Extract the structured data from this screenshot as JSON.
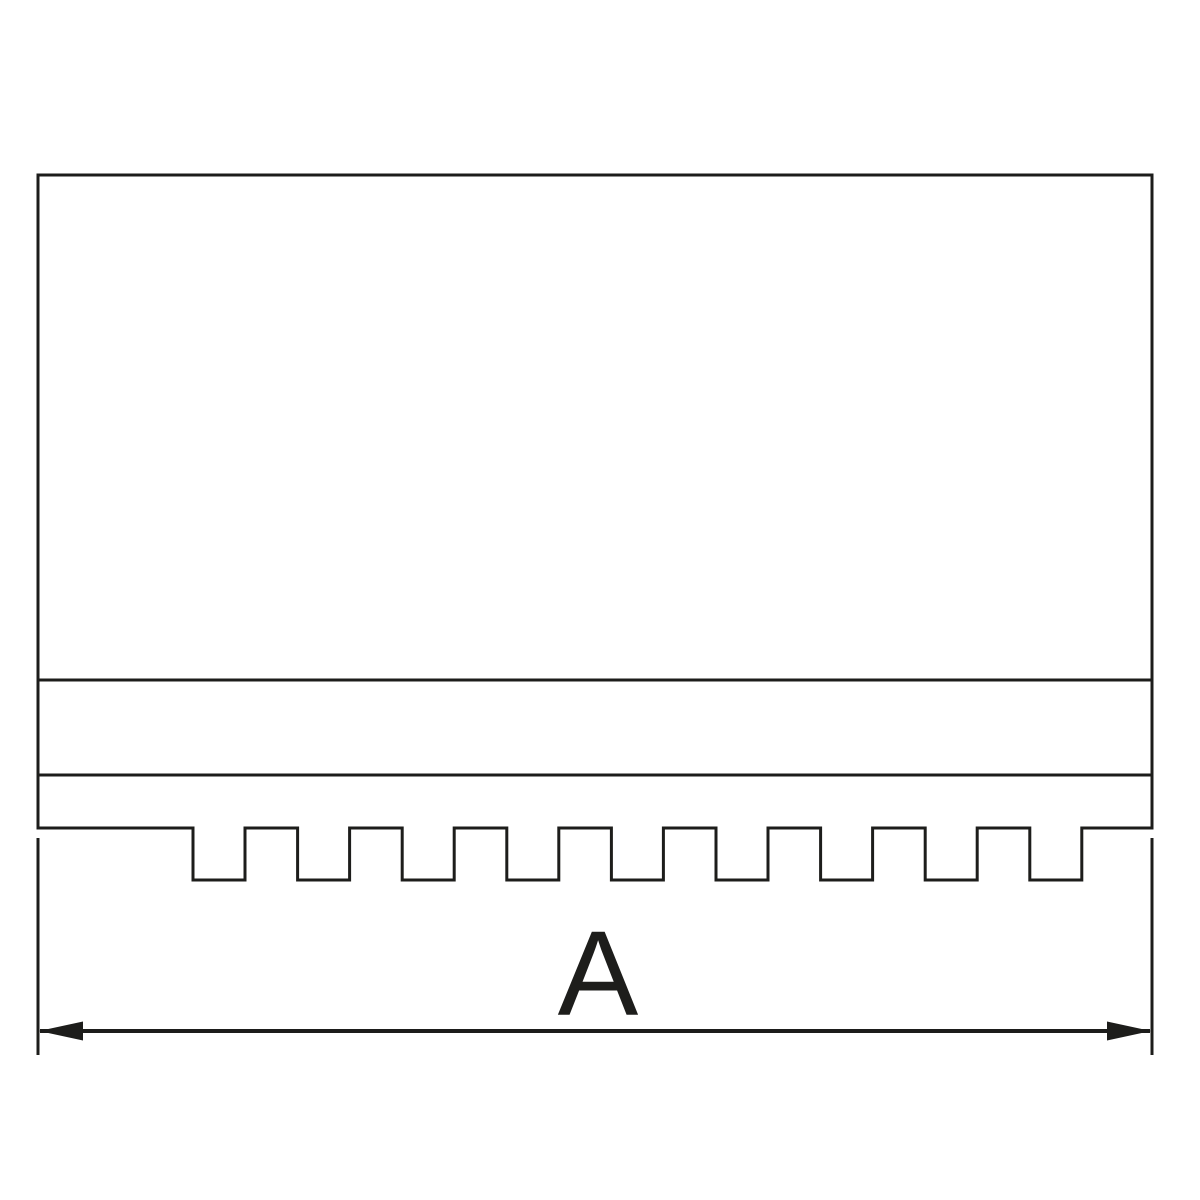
{
  "drawing": {
    "kind": "technical-profile-drawing",
    "dimension_label": "A",
    "line_color": "#1d1d1b",
    "background_color": "#ffffff",
    "geometry": {
      "canvas": {
        "width": 1200,
        "height": 1200
      },
      "body": {
        "left": 38,
        "right": 1152,
        "top": 175,
        "bottom": 828
      },
      "section_lines_y": [
        680,
        775
      ],
      "serration": {
        "notch_count": 9,
        "first_notch_x": 193,
        "pitch": 104.6,
        "notch_width": 52,
        "tooth_depth": 52
      },
      "dimension": {
        "line_y": 1031,
        "ext_top": 838,
        "ext_bottom": 1055,
        "arrow_length": 44,
        "arrow_half_height": 9.5,
        "label_x": 598,
        "label_baseline_y": 1015,
        "label_font_size": 121
      }
    }
  }
}
